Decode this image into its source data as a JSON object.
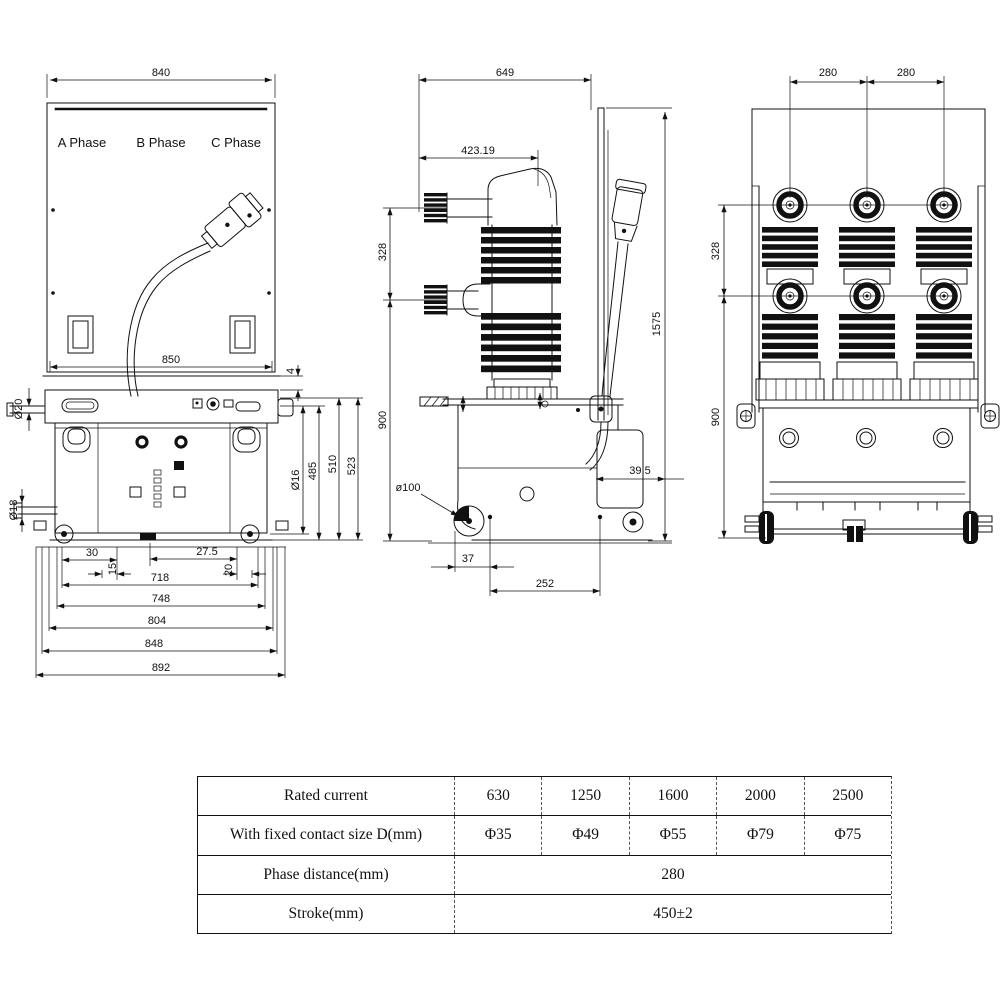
{
  "front": {
    "phases": [
      "A Phase",
      "B Phase",
      "C Phase"
    ],
    "d840": "840",
    "d850": "850",
    "d4": "4",
    "dia20": "Ø20",
    "dia18": "Ø18",
    "dia16": "Ø16",
    "d485": "485",
    "d510": "510",
    "d523": "523",
    "d30": "30",
    "d27_5": "27.5",
    "d15": "15",
    "d718": "718",
    "d20": "20",
    "d748": "748",
    "d804": "804",
    "d848": "848",
    "d892": "892"
  },
  "side": {
    "d649": "649",
    "d423": "423.19",
    "d328": "328",
    "d1575": "1575",
    "d900": "900",
    "dia100": "ø100",
    "d39_5": "39.5",
    "d37": "37",
    "d252": "252"
  },
  "rear": {
    "d280a": "280",
    "d280b": "280",
    "d328": "328",
    "d900": "900"
  },
  "table": {
    "rows": [
      {
        "label": "Rated current",
        "values": [
          "630",
          "1250",
          "1600",
          "2000",
          "2500"
        ]
      },
      {
        "label": "With fixed contact size D(mm)",
        "values": [
          "Φ35",
          "Φ49",
          "Φ55",
          "Φ79",
          "Φ75"
        ]
      },
      {
        "label": "Phase distance(mm)",
        "value": "280"
      },
      {
        "label": "Stroke(mm)",
        "value": "450±2"
      }
    ]
  }
}
